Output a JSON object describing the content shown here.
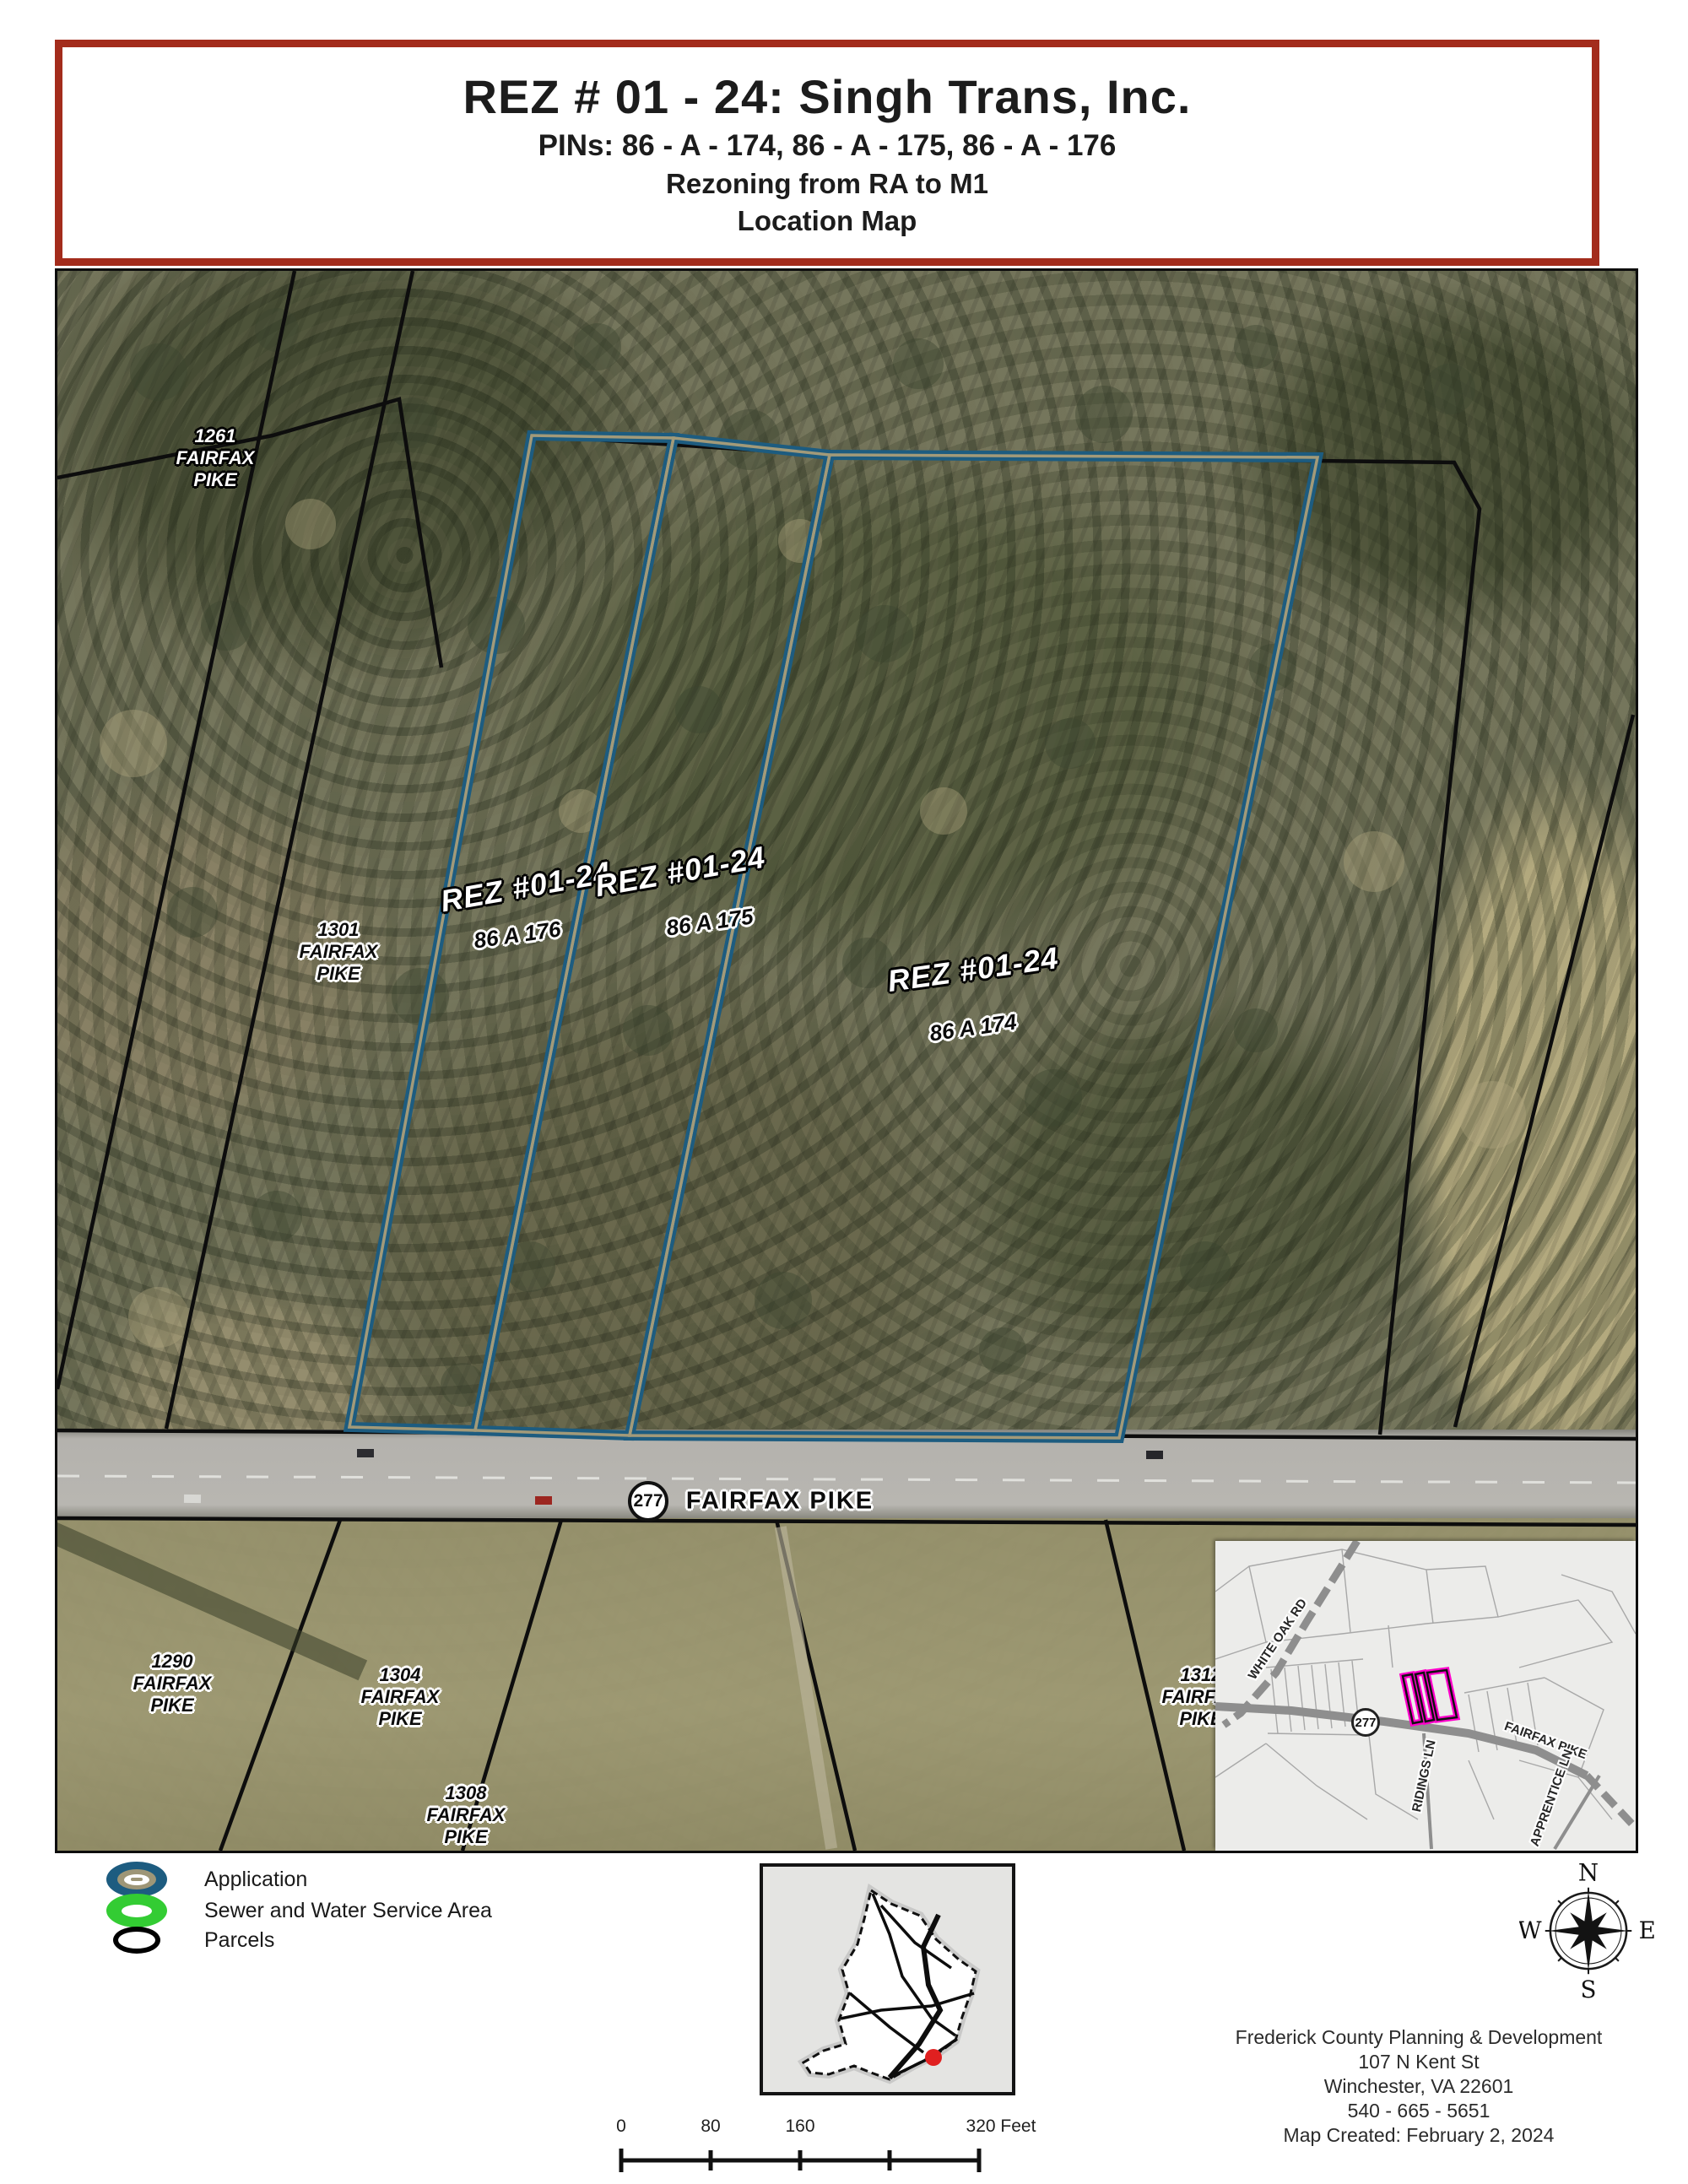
{
  "title_block": {
    "line1": "REZ # 01 - 24: Singh Trans, Inc.",
    "line2": "PINs: 86 - A - 174, 86 - A - 175, 86 - A - 176",
    "line3": "Rezoning from RA to M1",
    "line4": "Location Map",
    "border_color": "#a32c1c"
  },
  "map": {
    "route_shield": "277",
    "road_name": "FAIRFAX PIKE",
    "application_outline_color": "#1d5c80",
    "parcel_line_color": "#0d0d0d",
    "addresses": [
      {
        "l1": "1261",
        "l2": "FAIRFAX",
        "l3": "PIKE"
      },
      {
        "l1": "1301",
        "l2": "FAIRFAX",
        "l3": "PIKE"
      },
      {
        "l1": "1290",
        "l2": "FAIRFAX",
        "l3": "PIKE"
      },
      {
        "l1": "1304",
        "l2": "FAIRFAX",
        "l3": "PIKE"
      },
      {
        "l1": "1308",
        "l2": "FAIRFAX",
        "l3": "PIKE"
      },
      {
        "l1": "1312",
        "l2": "FAIRFAX",
        "l3": "PIKE"
      }
    ],
    "rez": [
      {
        "name": "REZ #01-24",
        "pin": "86 A 176"
      },
      {
        "name": "REZ #01-24",
        "pin": "86 A 175"
      },
      {
        "name": "REZ #01-24",
        "pin": "86 A 174"
      }
    ]
  },
  "inset": {
    "white_oak_rd": "WHITE OAK RD",
    "fairfax_pike": "FAIRFAX PIKE",
    "ridings_ln": "RIDINGS LN",
    "apprentice_ln": "APPRENTICE LN",
    "shield": "277",
    "highlight_color": "#ff00cc"
  },
  "legend": {
    "items": [
      {
        "label": "Application",
        "color": "#1d5c80"
      },
      {
        "label": "Sewer and Water Service Area",
        "color": "#33cc33"
      },
      {
        "label": "Parcels",
        "color": "#000000"
      }
    ]
  },
  "compass": {
    "n": "N",
    "e": "E",
    "s": "S",
    "w": "W"
  },
  "county_inset": {
    "dot_color": "#e02020"
  },
  "credits": {
    "line1": "Frederick County Planning & Development",
    "line2": "107 N Kent St",
    "line3": "Winchester, VA 22601",
    "line4": "540 - 665 - 5651",
    "line5": "Map Created: February 2, 2024"
  },
  "scalebar": {
    "t0": "0",
    "t80": "80",
    "t160": "160",
    "t320": "320 Feet"
  }
}
